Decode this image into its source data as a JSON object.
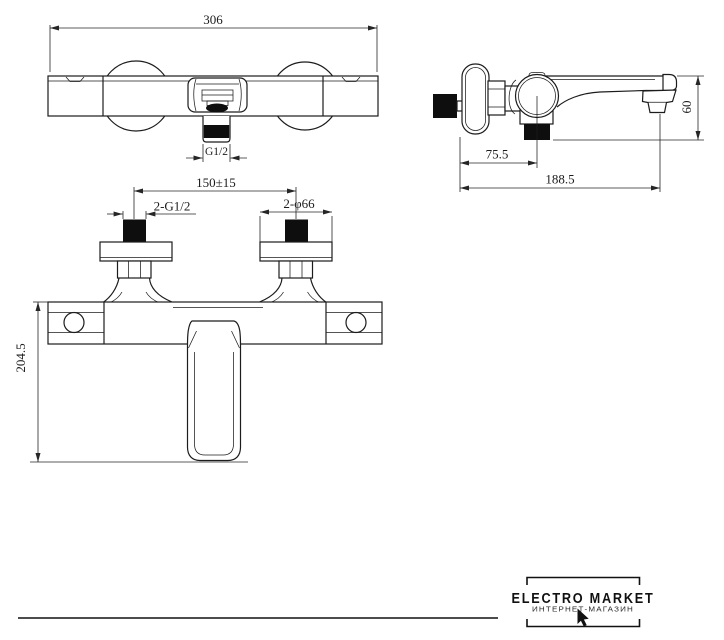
{
  "colors": {
    "line": "#1c1c1c",
    "black_fill": "#0e0e0e",
    "background": "#ffffff"
  },
  "front_view": {
    "width_dim": "306",
    "outlet_thread_dim": "G1/2"
  },
  "installation_view": {
    "inlet_spacing_dim": "150±15",
    "inlet_thread_dim": "2-G1/2",
    "flange_diameter_dim": "2-φ66",
    "height_dim": "204.5"
  },
  "side_view": {
    "spout_height_dim": "60",
    "wall_to_valve_center_dim": "75.5",
    "wall_to_spout_tip_dim": "188.5"
  },
  "logo": {
    "brand": "ELECTRO MARKET",
    "subtitle": "ИНТЕРНЕТ-МАГАЗИН"
  }
}
